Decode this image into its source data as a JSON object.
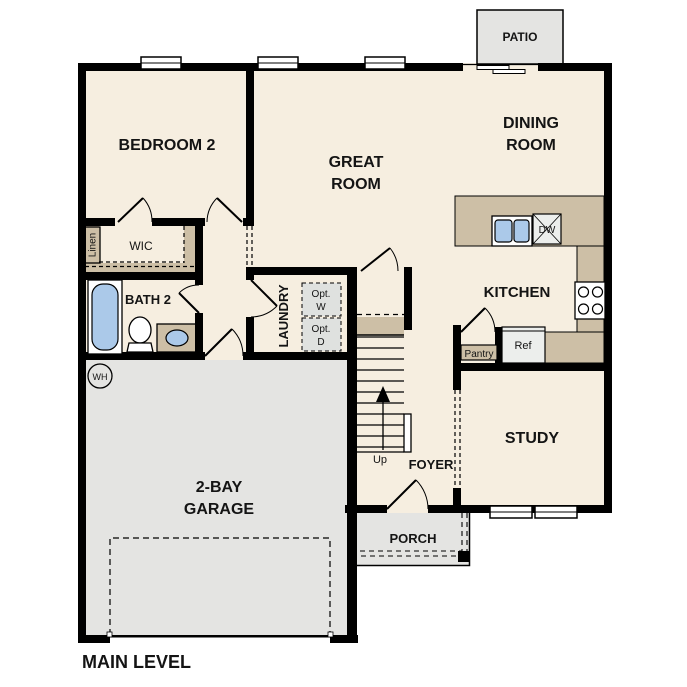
{
  "plan": {
    "level_label": "MAIN LEVEL",
    "rooms": {
      "bedroom2": "BEDROOM 2",
      "great_room": [
        "GREAT",
        "ROOM"
      ],
      "dining_room": [
        "DINING",
        "ROOM"
      ],
      "kitchen": "KITCHEN",
      "bath2": "BATH 2",
      "wic": "WIC",
      "laundry": "LAUNDRY",
      "study": "STUDY",
      "foyer": "FOYER",
      "porch": "PORCH",
      "patio": "PATIO",
      "garage": [
        "2-BAY",
        "GARAGE"
      ]
    },
    "fixtures": {
      "linen": "Linen",
      "pantry": "Pantry",
      "refrigerator": "Ref",
      "dishwasher": "DW",
      "water_heater": "WH",
      "optional_washer": [
        "Opt.",
        "W"
      ],
      "optional_dryer": [
        "Opt.",
        "D"
      ],
      "stairs_up": "Up"
    },
    "colors": {
      "floor_cream": "#f6eee0",
      "counter_tan": "#cdbfa6",
      "hardscape_gray": "#e4e4e2",
      "fixture_blue": "#abc9e9",
      "wall_black": "#000000"
    }
  }
}
